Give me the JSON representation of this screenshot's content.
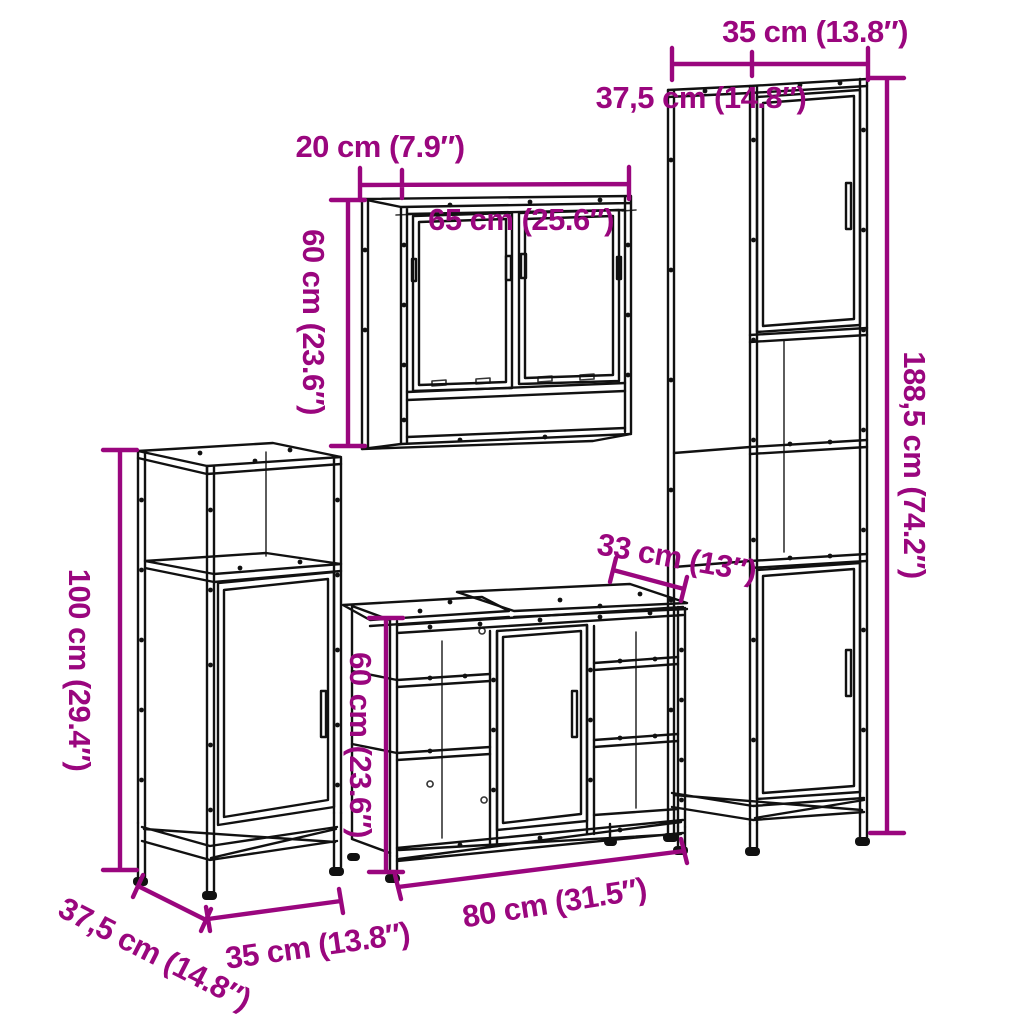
{
  "style": {
    "background_color": "#ffffff",
    "accent_color": "#9A067E",
    "line_color": "#111111"
  },
  "pieces": [
    {
      "id": "tall-cabinet",
      "labels": {
        "width": "35 cm (13.8″)",
        "depth": "37,5 cm (14.8″)",
        "height": "188,5 cm (74.2″)"
      }
    },
    {
      "id": "mirror-cabinet",
      "labels": {
        "depth": "20 cm (7.9″)",
        "width": "65 cm (25.6″)",
        "height": "60 cm (23.6″)"
      }
    },
    {
      "id": "side-cabinet",
      "labels": {
        "height": "100 cm (29.4″)",
        "depth": "37,5 cm (14.8″)",
        "width": "35 cm (13.8″)"
      }
    },
    {
      "id": "sink-cabinet",
      "labels": {
        "depth": "33 cm (13″)",
        "height": "60 cm (23.6″)",
        "width": "80 cm (31.5″)"
      }
    }
  ]
}
